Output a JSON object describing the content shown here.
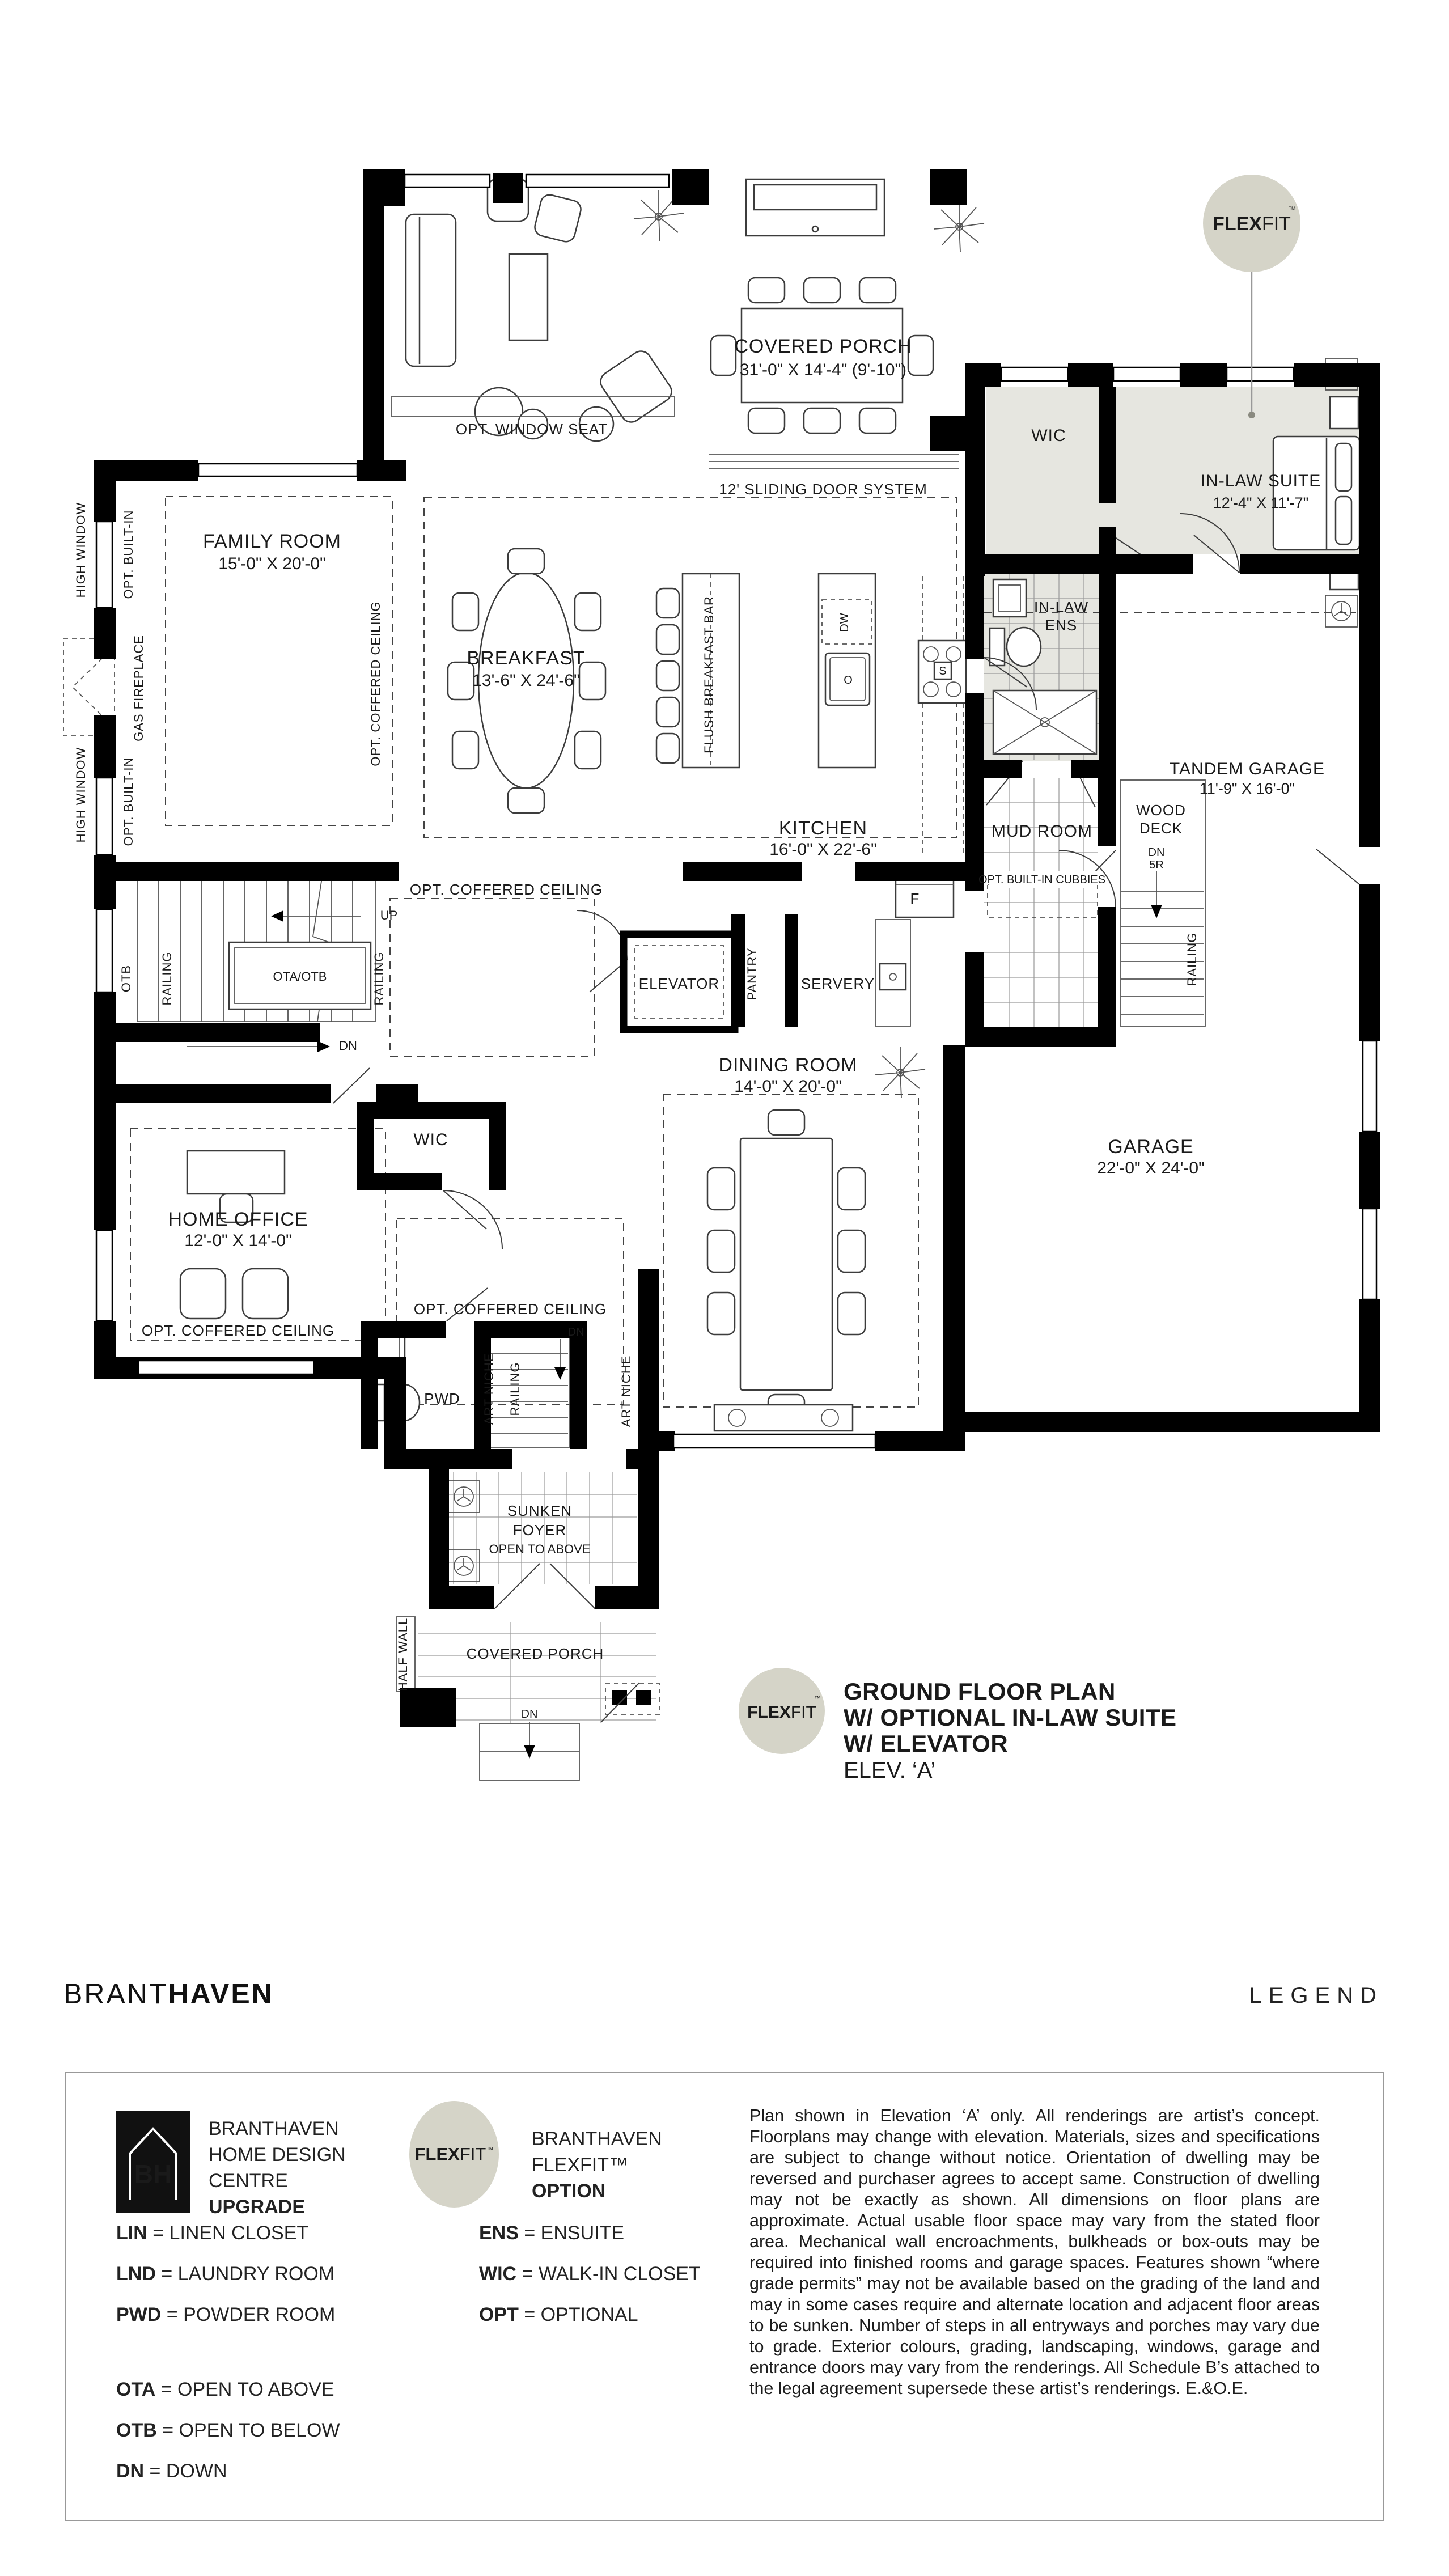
{
  "plan": {
    "badge": {
      "b": "FLEX",
      "l": "FIT",
      "tm": "™"
    },
    "rooms": {
      "porchTop": {
        "name": "COVERED PORCH",
        "dims": "31'-0\" X 14'-4\" (9'-10\")"
      },
      "family": {
        "name": "FAMILY ROOM",
        "dims": "15'-0\" X 20'-0\""
      },
      "breakfast": {
        "name": "BREAKFAST",
        "dims": "13'-6\" X 24'-6\""
      },
      "kitchen": {
        "name": "KITCHEN",
        "dims": "16'-0\" X 22'-6\""
      },
      "suite": {
        "name": "IN-LAW SUITE",
        "dims": "12'-4\" X 11'-7\""
      },
      "wicSuite": "WIC",
      "ens": {
        "line1": "IN-LAW",
        "line2": "ENS"
      },
      "tandem": {
        "name": "TANDEM GARAGE",
        "dims": "11'-9\" X 16'-0\""
      },
      "mud": "MUD ROOM",
      "deck": {
        "line1": "WOOD",
        "line2": "DECK",
        "dn": "DN",
        "risers": "5R"
      },
      "garage": {
        "name": "GARAGE",
        "dims": "22'-0\" X 24'-0\""
      },
      "dining": {
        "name": "DINING ROOM",
        "dims": "14'-0\" X 20'-0\""
      },
      "elevator": "ELEVATOR",
      "pantry": "PANTRY",
      "servery": "SERVERY",
      "office": {
        "name": "HOME OFFICE",
        "dims": "12'-0\" X 14'-0\""
      },
      "wicMain": "WIC",
      "pwd": "PWD",
      "foyer": {
        "line1": "SUNKEN",
        "line2": "FOYER",
        "note": "OPEN TO ABOVE"
      },
      "porchBottom": "COVERED PORCH",
      "stairWell": "OTA/OTB"
    },
    "ann": {
      "windowSeat": "OPT. WINDOW SEAT",
      "slidingDoor": "12' SLIDING DOOR SYSTEM",
      "coffered": "OPT. COFFERED CEILING",
      "highWindow": "HIGH WINDOW",
      "builtIn": "OPT. BUILT-IN",
      "fireplace": "GAS FIREPLACE",
      "bar": "FLUSH BREAKFAST BAR",
      "cubbies": "OPT. BUILT-IN CUBBIES",
      "railing": "RAILING",
      "halfWall": "HALF WALL",
      "artNiche": "ART NICHE",
      "otb": "OTB",
      "up": "UP",
      "dn": "DN",
      "dw": "DW",
      "f": "F",
      "s": "S",
      "o": "O"
    },
    "title": {
      "l1": "GROUND FLOOR PLAN",
      "l2": "W/ OPTIONAL IN-LAW SUITE",
      "l3": "W/ ELEVATOR",
      "l4": "ELEV. ‘A’"
    }
  },
  "footer": {
    "brand": {
      "light": "BRANT",
      "bold": "HAVEN"
    },
    "legendTitle": "LEGEND",
    "equals": " = ",
    "bhUpgrade": {
      "logo": "BH",
      "line1": "BRANTHAVEN",
      "line2": "HOME DESIGN",
      "line3": "CENTRE",
      "emphasis": "UPGRADE"
    },
    "flexfitOption": {
      "badgeB": "FLEX",
      "badgeL": "FIT",
      "tm": "™",
      "line1": "BRANTHAVEN",
      "line2": "FLEXFIT™",
      "emphasis": "OPTION"
    },
    "abbreviations": {
      "col1": [
        {
          "abbr": "LIN",
          "def": "LINEN CLOSET"
        },
        {
          "abbr": "LND",
          "def": "LAUNDRY ROOM"
        },
        {
          "abbr": "PWD",
          "def": "POWDER ROOM"
        }
      ],
      "col1b": [
        {
          "abbr": "OTA",
          "def": "OPEN TO ABOVE"
        },
        {
          "abbr": "OTB",
          "def": "OPEN TO BELOW"
        },
        {
          "abbr": "DN",
          "def": "DOWN"
        }
      ],
      "col2": [
        {
          "abbr": "ENS",
          "def": "ENSUITE"
        },
        {
          "abbr": "WIC",
          "def": "WALK-IN CLOSET"
        },
        {
          "abbr": "OPT",
          "def": "OPTIONAL"
        }
      ]
    },
    "disclaimer": "Plan shown in Elevation ‘A’ only. All renderings are artist’s concept. Floorplans may change with elevation. Materials, sizes and specifications are subject to change without notice. Orientation of dwelling may be reversed and purchaser agrees to accept same. Construction of dwelling may not be exactly as shown. All dimensions on floor plans are approximate. Actual usable floor space may vary from the stated floor area. Mechanical wall encroachments, bulkheads or box-outs may be required into finished rooms and garage spaces. Features shown “where grade permits” may not be available based on the grading of the land and may in some cases require and alternate location and adjacent floor areas to be sunken. Number of steps in all entryways and porches may vary due to grade. Exterior colours, grading, landscaping, windows, garage and entrance doors may vary from the renderings. All Schedule B’s attached to the legal agreement supersede these artist’s renderings. E.&O.E."
  },
  "colors": {
    "badge": "#d5d4c8",
    "shade": "#e6e6e0",
    "wall": "#000000"
  }
}
